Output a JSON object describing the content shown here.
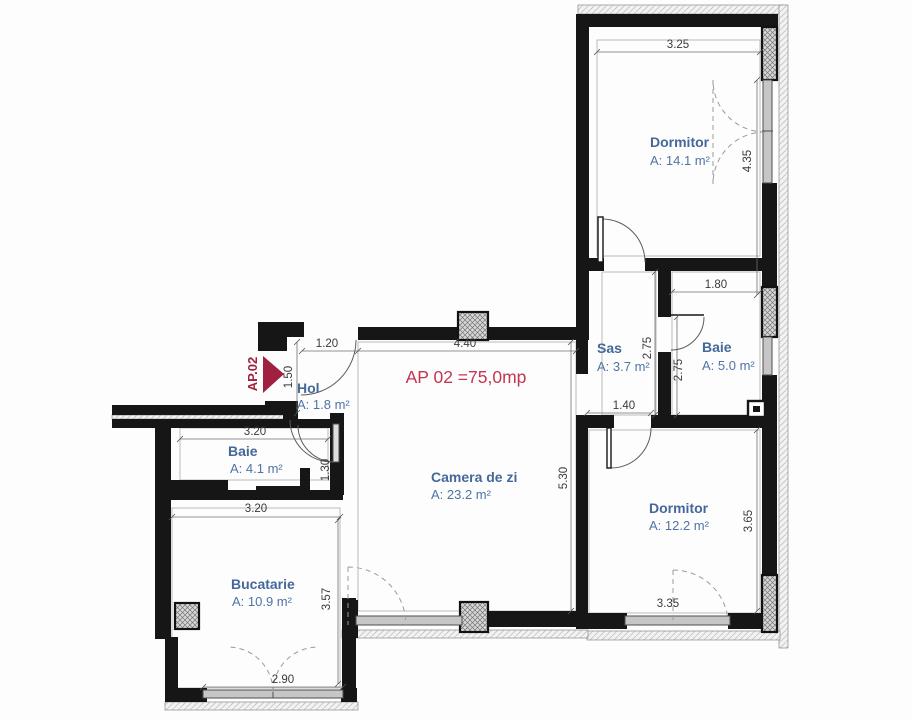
{
  "plan": {
    "marker": "AP.02",
    "title": "AP 02 =75,0mp",
    "rooms": [
      {
        "name": "Dormitor",
        "area": "A: 14.1  m²"
      },
      {
        "name": "Sas",
        "area": "A: 3.7  m²"
      },
      {
        "name": "Baie",
        "area": "A: 5.0  m²"
      },
      {
        "name": "Hol",
        "area": "A: 1.8  m²"
      },
      {
        "name": "Baie",
        "area": "A: 4.1  m²"
      },
      {
        "name": "Camera de zi",
        "area": "A: 23.2  m²"
      },
      {
        "name": "Dormitor",
        "area": "A: 12.2  m²"
      },
      {
        "name": "Bucatarie",
        "area": "A: 10.9 m²"
      }
    ],
    "dimensions": {
      "dorm1_width": "3.25",
      "dorm1_height": "4.35",
      "baie2_width": "1.80",
      "sas_height": "2.75",
      "baie2_height": "2.75",
      "dorm2_door": "1.40",
      "camera_height": "5.30",
      "dorm2_height": "3.65",
      "dorm2_width": "3.35",
      "entry_width": "1.20",
      "camera_width": "4.40",
      "hol_height": "1.50",
      "hol_wall": "1.30",
      "baie1_width": "3.20",
      "bucatarie_width": "3.20",
      "bucatarie_height": "3.57",
      "bucatarie_window": "2.90"
    },
    "colors": {
      "wall": "#161616",
      "label_blue": "#44689a",
      "title_red": "#c23652",
      "marker_red": "#a02040"
    }
  }
}
